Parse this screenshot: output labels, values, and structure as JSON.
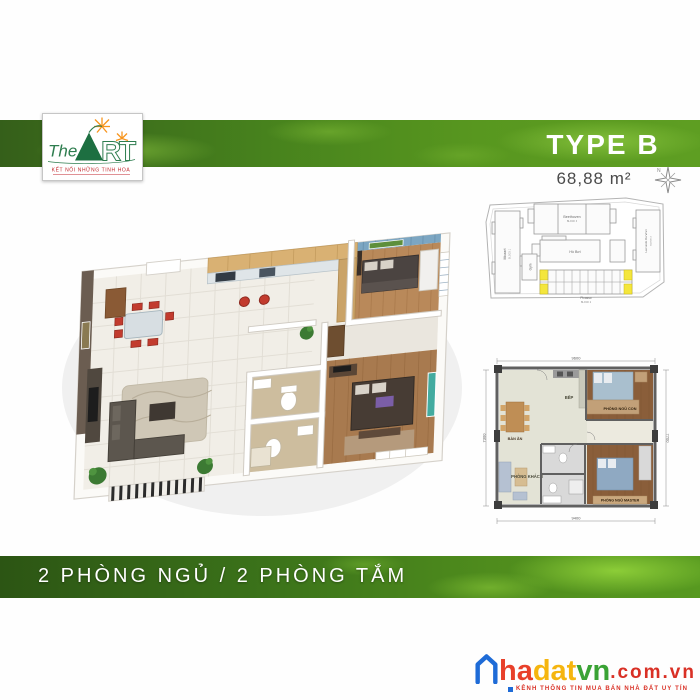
{
  "header": {
    "type_label": "TYPE B",
    "area_label": "68,88 m²"
  },
  "logo": {
    "the": "The",
    "letter_r": "R",
    "letter_t": "T",
    "tagline": "KẾT NỐI NHỮNG TINH HOA"
  },
  "icons": {
    "compass": "compass-rose-icon",
    "compass_letter": "N",
    "house": "house-outline-icon"
  },
  "site_plan": {
    "mozart": "Mozart",
    "mozart_block": "BLOCK 1",
    "beethoven": "Beethoven",
    "beethoven_block": "BLOCK 3",
    "pool": "Hồ Bơi",
    "gym": "Gym",
    "picasso": "Picasso",
    "picasso_block": "BLOCK 2",
    "leonardo": "Leonardo Da Vinci",
    "leonardo_block": "BLOCK 4",
    "highlight_color": "#f4e63c"
  },
  "plan2d": {
    "rooms": {
      "dining": "BÀN ĂN",
      "kitchen": "BẾP",
      "bedroom_kid": "PHÒNG NGỦ CON",
      "living": "PHÒNG KHÁCH",
      "bedroom_master": "PHÒNG NGỦ MASTER"
    },
    "dims": {
      "top": "9600",
      "bottom": "9400",
      "left": "7300",
      "right": "7700"
    }
  },
  "footer": {
    "caption": "2 PHÒNG NGỦ / 2 PHÒNG TẮM"
  },
  "watermark": {
    "part1": "ha",
    "part2": "dat",
    "part3": "vn",
    "suffix": ".com.vn",
    "tagline": "KÊNH THÔNG TIN MUA BÁN NHÀ ĐẤT UY TÍN"
  },
  "colors": {
    "band_green_dark": "#2c5514",
    "band_green_light": "#8ccc3f",
    "logo_green": "#2e7d4f",
    "logo_orange": "#f7941d",
    "logo_red": "#c1272d",
    "area_text": "#4a4a4a",
    "watermark_blue": "#1e6bd7",
    "watermark_red": "#e8402a",
    "watermark_yellow": "#f5b50f",
    "watermark_green": "#3aa335"
  }
}
